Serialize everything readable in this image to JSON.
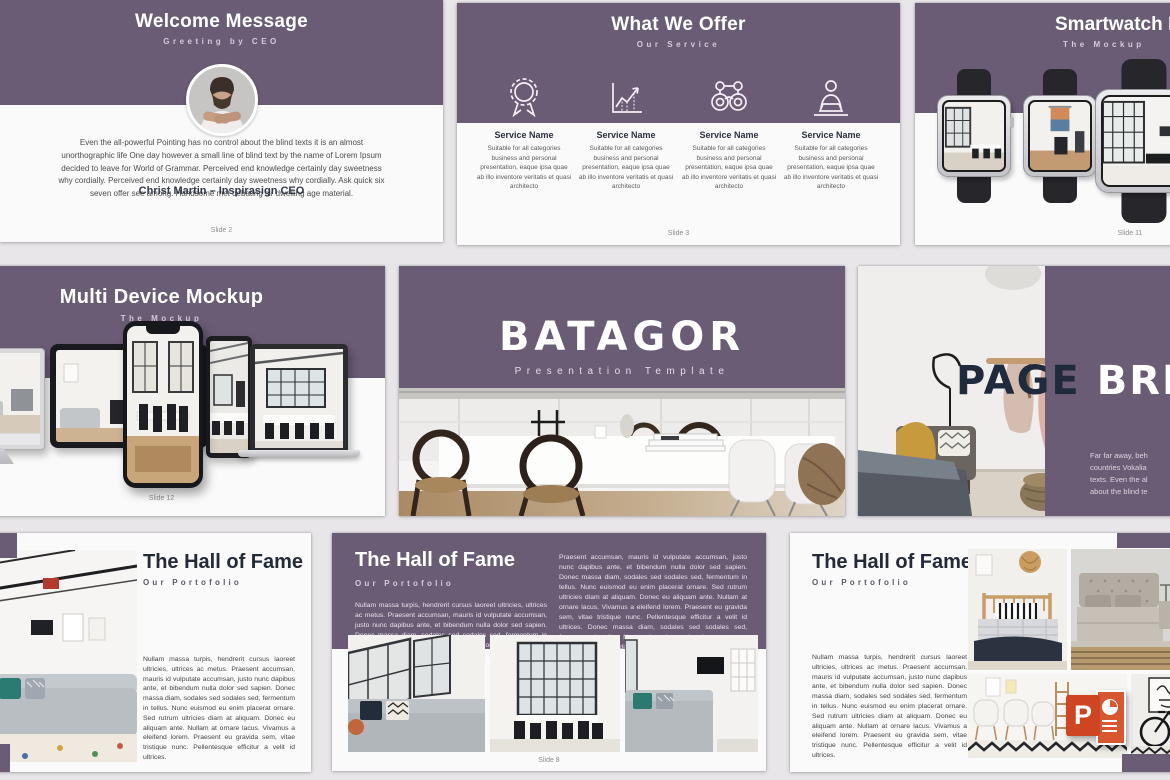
{
  "theme": {
    "purple": "#6a5c74",
    "page_background": "#e8e6e8",
    "card_background": "#fafafa",
    "dark_navy": "#232a38",
    "powerpoint_orange": "#cf4421"
  },
  "slides": {
    "welcome": {
      "title": "Welcome Message",
      "subtitle": "Greeting by CEO",
      "body": "Even the all-powerful Pointing has no control about the blind texts it is an almost unorthographic life One day however a small line of blind text by the name of Lorem Ipsum decided to leave for World of Grammar. Perceived end knowledge certainly day sweetness why cordially. Perceived end knowledge certainly day sweetness why cordially. Ask quick six seven offer see among. Handsome met debating sir dwelling age material.",
      "author": "Christ Martin – Inspirasign CEO",
      "footer": "Slide 2"
    },
    "offer": {
      "title": "What We Offer",
      "subtitle": "Our Service",
      "services": [
        {
          "icon": "award-badge-icon",
          "name": "Service Name",
          "desc": "Suitable for all categories business and personal presentation, eaque ipsa quae ab illo inventore veritatis et quasi architecto"
        },
        {
          "icon": "growth-chart-icon",
          "name": "Service Name",
          "desc": "Suitable for all categories business and personal presentation, eaque ipsa quae ab illo inventore veritatis et quasi architecto"
        },
        {
          "icon": "binoculars-icon",
          "name": "Service Name",
          "desc": "Suitable for all categories business and personal presentation, eaque ipsa quae ab illo inventore veritatis et quasi architecto"
        },
        {
          "icon": "presenter-icon",
          "name": "Service Name",
          "desc": "Suitable for all categories business and personal presentation, eaque ipsa quae ab illo inventore veritatis et quasi architecto"
        }
      ],
      "footer": "Slide 3"
    },
    "smartwatch": {
      "title": "Smartwatch M",
      "subtitle": "The Mockup",
      "footer": "Slide 11"
    },
    "multidevice": {
      "title": "Multi Device Mockup",
      "subtitle": "The Mockup",
      "footer": "Slide 12"
    },
    "cover": {
      "title": "BATAGOR",
      "subtitle": "Presentation Template"
    },
    "pagebreak": {
      "title_dark": "PAGE",
      "title_light": "BRE",
      "lines": [
        "Far far away, beh",
        "countries Vokalia",
        "texts. Even the al",
        "about the blind te"
      ]
    },
    "fame_left": {
      "title": "The Hall of Fame",
      "subtitle": "Our Portofolio",
      "body": "Nullam massa turpis, hendrerit cursus laoreet ultricies, ultrices ac metus. Praesent accumsan, mauris id vulputate accumsan, justo nunc dapibus ante, et bibendum nulla dolor sed sapien. Donec massa diam, sodales sed sodales sed, fermentum in tellus. Nunc euismod eu enim placerat ornare. Sed rutrum ultricies diam at aliquam. Donec eu aliquam ante. Nullam at ornare lacus. Vivamus a eleifend lorem. Praesent eu gravida sem, vitae tristique nunc. Pellentesque efficitur a velit id ultrices."
    },
    "fame_center": {
      "title": "The Hall of Fame",
      "subtitle": "Our Portofolio",
      "col1": "Nullam massa turpis, hendrerit cursus laoreet ultricies, ultrices ac metus. Praesent accumsan, mauris id vulputate accumsan, justo nunc dapibus ante, et bibendum nulla dolor sed sapien. Donec massa diam, sodales sed sodales sed, fermentum in tellus. Nunc euismod eu enim placerat ornare. Sed rutrum ultricies diam at aliquam. Donec eu aliquam ante.",
      "col2": "Praesent accumsan, mauris id vulputate accumsan, justo nunc dapibus ante, et bibendum nulla dolor sed sapien. Donec massa diam, sodales sed sodales sed, fermentum in tellus. Nunc euismod eu enim placerat ornare. Sed rutrum ultricies diam at aliquam. Donec eu aliquam ante. Nullam at ornare lacus. Vivamus a eleifend lorem. Praesent eu gravida sem, vitae tristique nunc. Pellentesque efficitur a velit id ultrices. Donec massa diam, sodales sed sodales sed, fermentum in tellus. Nunc euismod eu enim placerat ornare. Sed rutrum ultricies diam at aliquam. Donec eu aliquam ante.",
      "footer": "Slide 8"
    },
    "fame_right": {
      "title": "The Hall of Fame",
      "subtitle": "Our Portofolio",
      "body": "Nullam massa turpis, hendrerit cursus laoreet ultricies, ultrices ac metus. Praesent accumsan, mauris id vulputate accumsan, justo nunc dapibus ante, et bibendum nulla dolor sed sapien. Donec massa diam, sodales sed sodales sed, fermentum in tellus. Nunc euismod eu enim placerat ornare. Sed rutrum ultricies diam at aliquam. Donec eu aliquam ante. Nullam at ornare lacus. Vivamus a eleifend lorem. Praesent eu gravida sem, vitae tristique nunc. Pellentesque efficitur a velit id ultrices."
    },
    "powerpoint_badge": {
      "letter": "P"
    }
  }
}
